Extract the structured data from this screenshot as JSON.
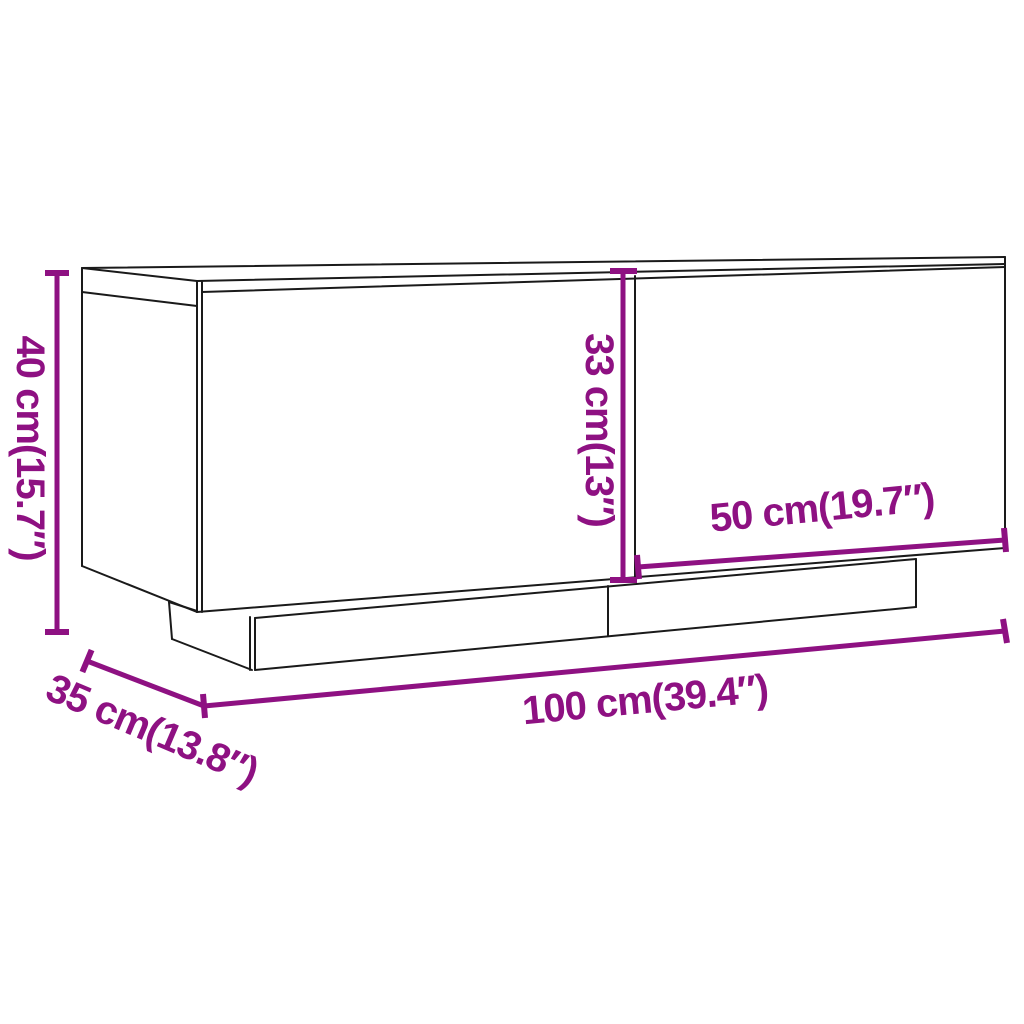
{
  "diagram": {
    "kind": "furniture-dimension-line-drawing",
    "colors": {
      "dimension_accent": "#8E1182",
      "drawing_outline": "#1A1A1A",
      "background": "#FFFFFF"
    },
    "labels": {
      "height": "40 cm(15.7″)",
      "door_height": "33 cm(13″)",
      "door_width": "50 cm(19.7″)",
      "width": "100 cm(39.4″)",
      "depth": "35 cm(13.8″)"
    }
  }
}
